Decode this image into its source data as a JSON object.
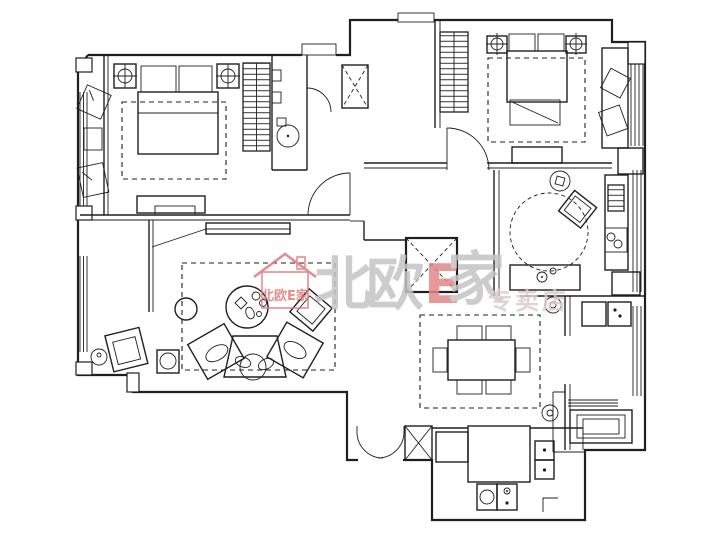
{
  "canvas": {
    "width": 728,
    "height": 536
  },
  "colors": {
    "background": "#ffffff",
    "line": "#1f1f1f",
    "watermark_gray": "#c4c4c4",
    "watermark_red": "#e2888a",
    "watermark_pink": "#ddcbca",
    "logo_red": "#e07a7a"
  },
  "watermark": {
    "logo_name": "house-logo",
    "logo_text": "北欧E家",
    "char_1": "北",
    "char_2": "欧",
    "char_3": "E",
    "char_4": "家",
    "subtitle": "专卖店"
  },
  "plan": {
    "type": "apartment-floor-plan",
    "style": "cad-black-line-drawing",
    "rooms": [
      {
        "name": "master-bedroom"
      },
      {
        "name": "master-balcony"
      },
      {
        "name": "bathroom"
      },
      {
        "name": "hallway"
      },
      {
        "name": "second-bedroom"
      },
      {
        "name": "study"
      },
      {
        "name": "living-room"
      },
      {
        "name": "living-balcony"
      },
      {
        "name": "dining-area"
      },
      {
        "name": "kitchen"
      },
      {
        "name": "bathroom-laundry"
      },
      {
        "name": "entry"
      }
    ],
    "furniture_symbols": [
      "double-bed",
      "pillow",
      "nightstand",
      "bedside-lamp",
      "wardrobe",
      "area-rug",
      "round-rug",
      "tv-cabinet",
      "lounge-chair",
      "side-table",
      "toilet",
      "duct-shaft",
      "door-swing",
      "sectional-sofa",
      "coffee-table",
      "armchair",
      "floor-lamp",
      "dining-table",
      "dining-chair",
      "ceiling-downlight",
      "desk",
      "desk-chair",
      "stool",
      "kitchen-island",
      "kitchen-counter",
      "sink",
      "cooktop",
      "wall-cabinet",
      "washing-machine",
      "bathtub",
      "radiator",
      "window",
      "window-seat"
    ]
  }
}
